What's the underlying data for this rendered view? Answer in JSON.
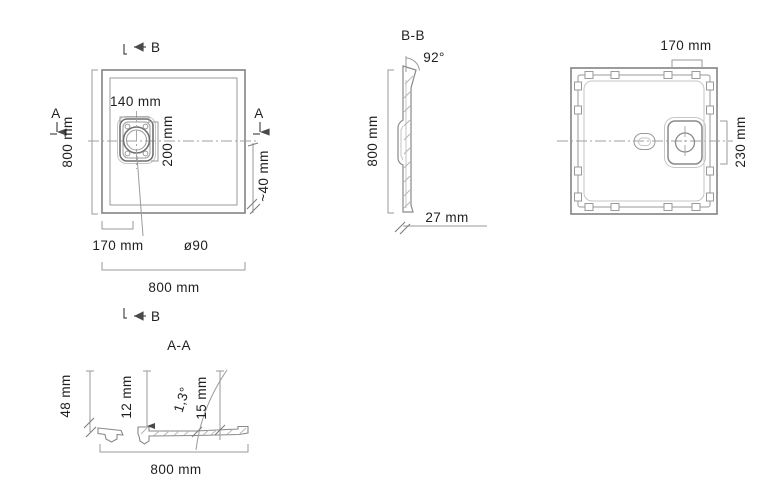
{
  "drawing": {
    "type": "technical-drawing-shower-tray",
    "colors": {
      "line": "#8a8a8a",
      "line_faint": "#c6c6c6",
      "dimension": "#9a9a9a",
      "text": "#1f1f1f"
    },
    "top_view": {
      "section_b_label": "B",
      "section_a_left_label": "A",
      "section_a_right_label": "A",
      "dim_drain_box_width": "140 mm",
      "dim_drain_box_height": "200 mm",
      "dim_rim": "~40 mm",
      "dim_drain_offset": "170 mm",
      "dim_drain_diameter": "ø90",
      "dim_width": "800 mm",
      "dim_height": "800 mm"
    },
    "section_bb": {
      "title": "B-B",
      "angle": "92°",
      "dim_height": "800 mm",
      "dim_thickness": "27 mm"
    },
    "bottom_view": {
      "dim_drain_offset_h": "170 mm",
      "dim_drain_offset_v": "230 mm"
    },
    "section_aa": {
      "title": "A-A",
      "section_b_label": "B",
      "dim_edge_height": "48 mm",
      "dim_floor_left": "12 mm",
      "angle": "1,3°",
      "dim_floor_right": "15 mm",
      "dim_width": "800 mm"
    }
  }
}
